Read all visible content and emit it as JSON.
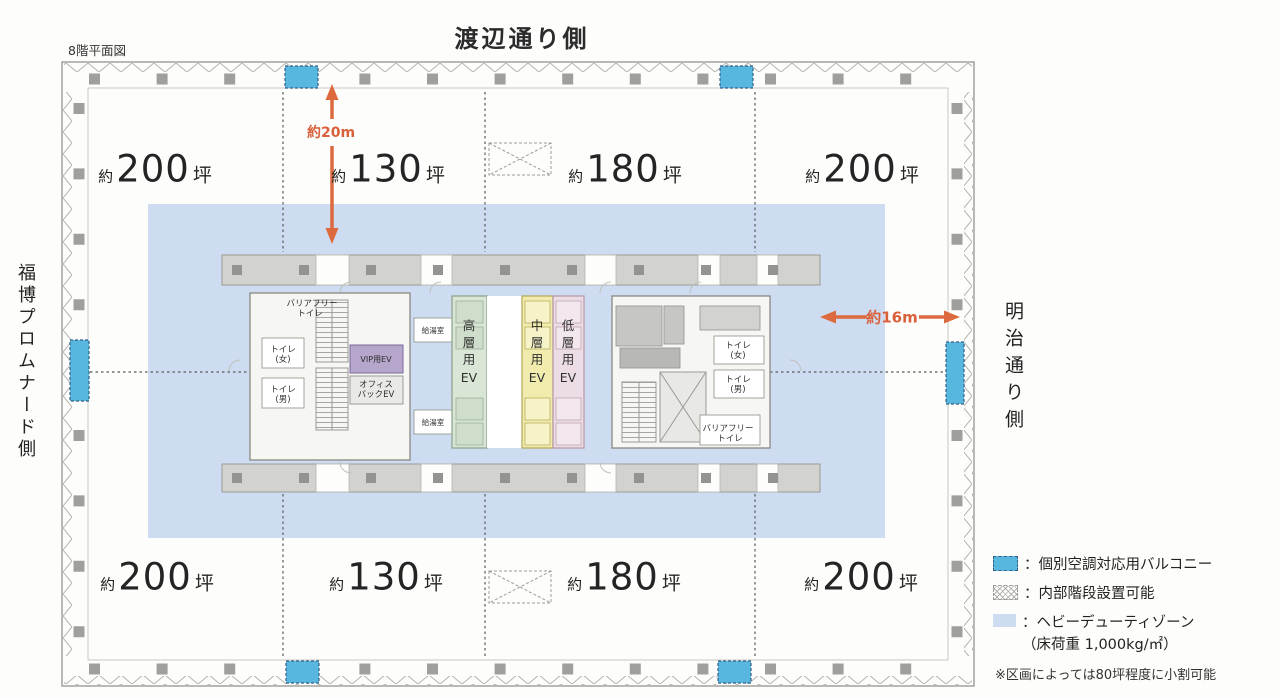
{
  "header": {
    "title": "渡辺通り側",
    "plan_label": "8階平面図"
  },
  "sides": {
    "left": "福博プロムナード側",
    "right": "明治通り側"
  },
  "areas": {
    "top": [
      {
        "approx": "約",
        "value": "200",
        "unit": "坪"
      },
      {
        "approx": "約",
        "value": "130",
        "unit": "坪"
      },
      {
        "approx": "約",
        "value": "180",
        "unit": "坪"
      },
      {
        "approx": "約",
        "value": "200",
        "unit": "坪"
      }
    ],
    "bottom": [
      {
        "approx": "約",
        "value": "200",
        "unit": "坪"
      },
      {
        "approx": "約",
        "value": "130",
        "unit": "坪"
      },
      {
        "approx": "約",
        "value": "180",
        "unit": "坪"
      },
      {
        "approx": "約",
        "value": "200",
        "unit": "坪"
      }
    ]
  },
  "dims": {
    "vertical": "約20m",
    "horizontal": "約16m"
  },
  "core": {
    "barrier_free": [
      "バリアフリー",
      "トイレ"
    ],
    "toilet_women": [
      "トイレ",
      "(女)"
    ],
    "toilet_men": [
      "トイレ",
      "(男)"
    ],
    "vip_ev": "VIP用EV",
    "office_back_ev": [
      "オフィス",
      "バックEV"
    ],
    "kitchenette": "給湯室",
    "ev_banks": {
      "high": {
        "chars": [
          "高",
          "層",
          "用",
          "EV"
        ]
      },
      "mid": {
        "chars": [
          "中",
          "層",
          "用",
          "EV"
        ]
      },
      "low": {
        "chars": [
          "低",
          "層",
          "用",
          "EV"
        ]
      }
    }
  },
  "legend": {
    "items": [
      {
        "label": "：個別空調対応用バルコニー",
        "swatch": "balcony"
      },
      {
        "label": "：内部階段設置可能",
        "swatch": "hatch"
      },
      {
        "label": "：ヘビーデューティゾーン",
        "label2": "（床荷重 1,000kg/㎡）",
        "swatch": "heavy"
      }
    ],
    "note": "※区画によっては80坪程度に小割可能"
  },
  "colors": {
    "arrow": "#dc6a3e",
    "balcony": "#57b7de",
    "heavy_zone": "#cddcf0",
    "ev_vip": "#b6a6cb",
    "ev_high": "#d9e6d5",
    "ev_mid": "#f1ecae",
    "ev_low": "#ecdce6"
  }
}
